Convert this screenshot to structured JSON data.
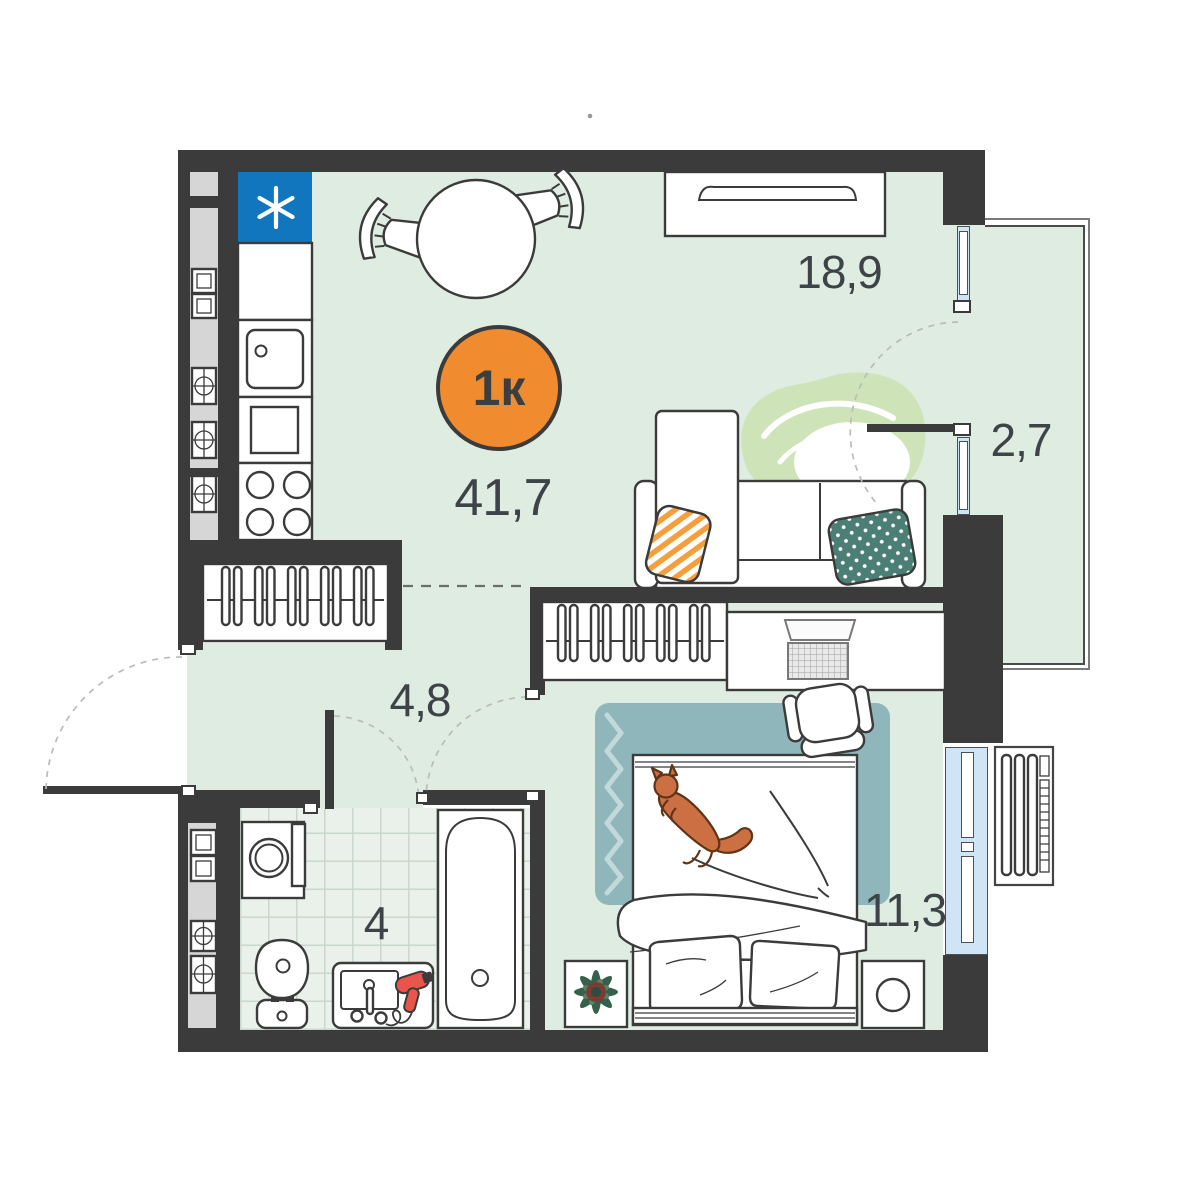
{
  "plan": {
    "type_badge": {
      "label": "1к"
    },
    "total_area": "41,7",
    "rooms": [
      {
        "id": "living-kitchen",
        "area": "18,9"
      },
      {
        "id": "balcony",
        "area": "2,7"
      },
      {
        "id": "hallway",
        "area": "4,8"
      },
      {
        "id": "bathroom",
        "area": "4"
      },
      {
        "id": "bedroom",
        "area": "11,3"
      }
    ],
    "icons": {
      "fridge_marker": "snowflake-asterisk"
    },
    "colors": {
      "wall": "#3B3B3C",
      "floor_green": "#DEECE1",
      "bathroom_tile": "#E9F1EA",
      "badge_orange": "#F08B2F",
      "fridge_blue": "#1276BF",
      "window_blue": "#CFE4F5",
      "rug_teal": "#8FB6BA",
      "pillow_teal": "#4B7E74",
      "pillow_orange": "#F59E3B",
      "decor_leaf_green": "#CFE3B8",
      "cat_orange": "#CC6F42",
      "hairdryer_red": "#E8554A"
    }
  }
}
